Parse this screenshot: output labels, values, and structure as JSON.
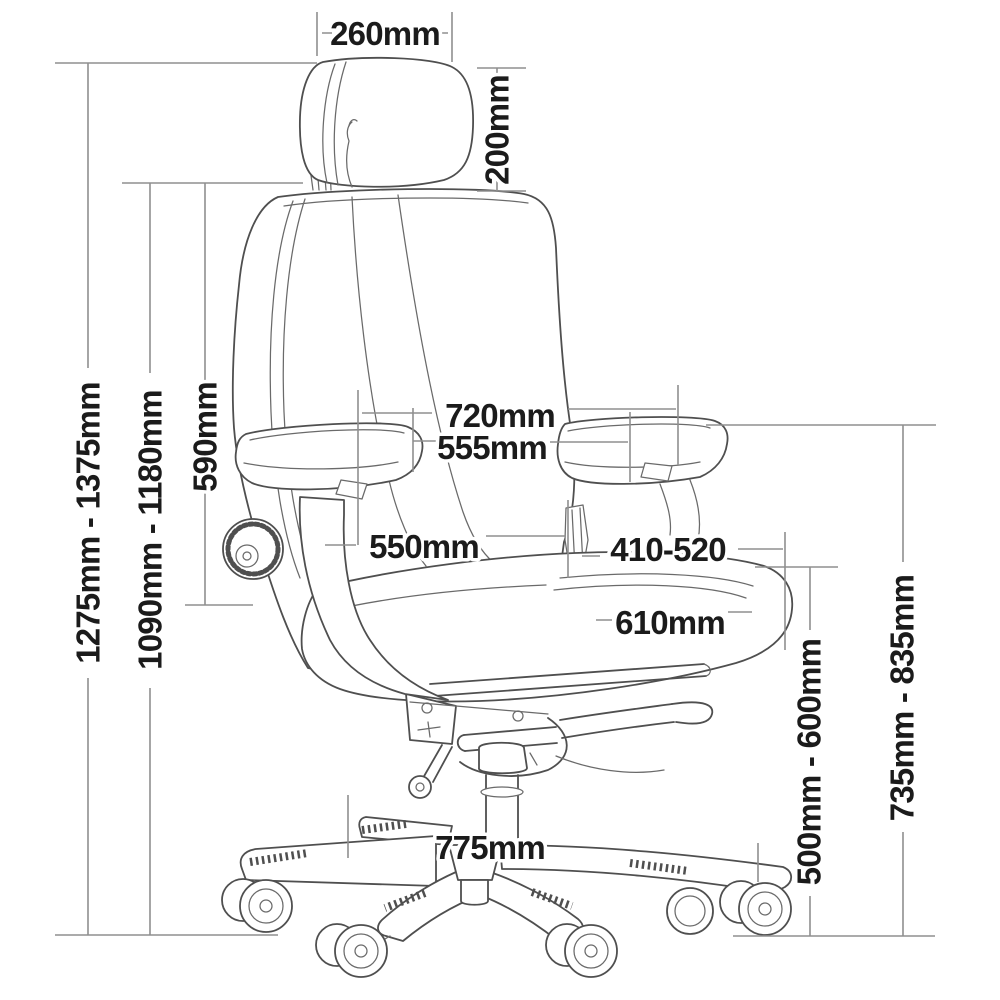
{
  "diagram": {
    "type": "product-dimension-diagram",
    "subject": "office chair line drawing with measurement annotations",
    "colors": {
      "background": "#ffffff",
      "line": "#4f4f4f",
      "thin": "#6a6a6a",
      "dim": "#8f8f8f",
      "text": "#1b1b1b"
    },
    "labels": {
      "headrest_width": "260mm",
      "headrest_height": "200mm",
      "overall_height_range": "1275mm - 1375mm",
      "backrest_top_height_range": "1090mm - 1180mm",
      "backrest_height": "590mm",
      "overall_width": "720mm",
      "armrest_inner_span": "555mm",
      "seat_width": "550mm",
      "seat_height_range": "410-520",
      "seat_depth": "610mm",
      "underseat_height_range": "500mm - 600mm",
      "armrest_height_range": "735mm - 835mm",
      "base_width": "775mm"
    }
  }
}
